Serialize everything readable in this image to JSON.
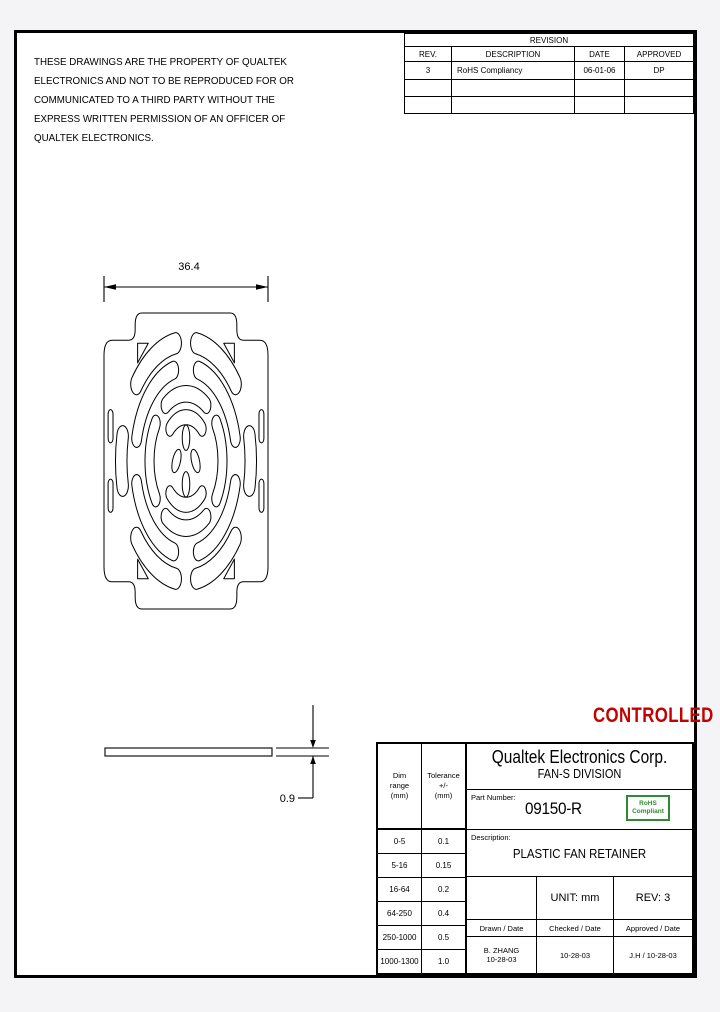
{
  "page": {
    "background": "#f4f4f7",
    "sheet_background": "#ffffff",
    "line_color": "#000000"
  },
  "notice": {
    "lines": [
      "THESE DRAWINGS ARE THE PROPERTY OF QUALTEK",
      "ELECTRONICS AND NOT TO BE REPRODUCED FOR OR",
      "COMMUNICATED TO A THIRD PARTY WITHOUT THE",
      "EXPRESS WRITTEN PERMISSION OF AN OFFICER OF",
      "QUALTEK ELECTRONICS."
    ]
  },
  "revision_table": {
    "title": "REVISION",
    "columns": [
      "REV.",
      "DESCRIPTION",
      "DATE",
      "APPROVED"
    ],
    "rows": [
      {
        "rev": "3",
        "description": "RoHS Compliancy",
        "date": "06-01-06",
        "approved": "DP"
      },
      {
        "rev": "",
        "description": "",
        "date": "",
        "approved": ""
      },
      {
        "rev": "",
        "description": "",
        "date": "",
        "approved": ""
      }
    ]
  },
  "front_view": {
    "width_dim": "36.4"
  },
  "side_view": {
    "thickness_dim": "0.9"
  },
  "stamp": {
    "text": "CONTROLLED",
    "color": "#c40000"
  },
  "title_block": {
    "company": "Qualtek Electronics Corp.",
    "division": "FAN-S DIVISION",
    "part_number_label": "Part Number:",
    "part_number": "09150-R",
    "rohs_badge": {
      "line1": "RoHS",
      "line2": "Compliant",
      "color": "#2e8b2e"
    },
    "description_label": "Description:",
    "description": "PLASTIC FAN RETAINER",
    "unit": "UNIT:  mm",
    "rev": "REV: 3",
    "signatures": {
      "drawn_label": "Drawn / Date",
      "checked_label": "Checked / Date",
      "approved_label": "Approved / Date",
      "drawn_name": "B. ZHANG",
      "drawn_date": "10-28-03",
      "checked": "10-28-03",
      "approved": "J.H / 10-28-03"
    },
    "tolerance_table": {
      "dim_header": [
        "Dim",
        "range",
        "(mm)"
      ],
      "tol_header": [
        "Tolerance",
        "+/-",
        "(mm)"
      ],
      "rows": [
        [
          "0-5",
          "0.1"
        ],
        [
          "5-16",
          "0.15"
        ],
        [
          "16-64",
          "0.2"
        ],
        [
          "64-250",
          "0.4"
        ],
        [
          "250-1000",
          "0.5"
        ],
        [
          "1000-1300",
          "1.0"
        ]
      ]
    }
  }
}
